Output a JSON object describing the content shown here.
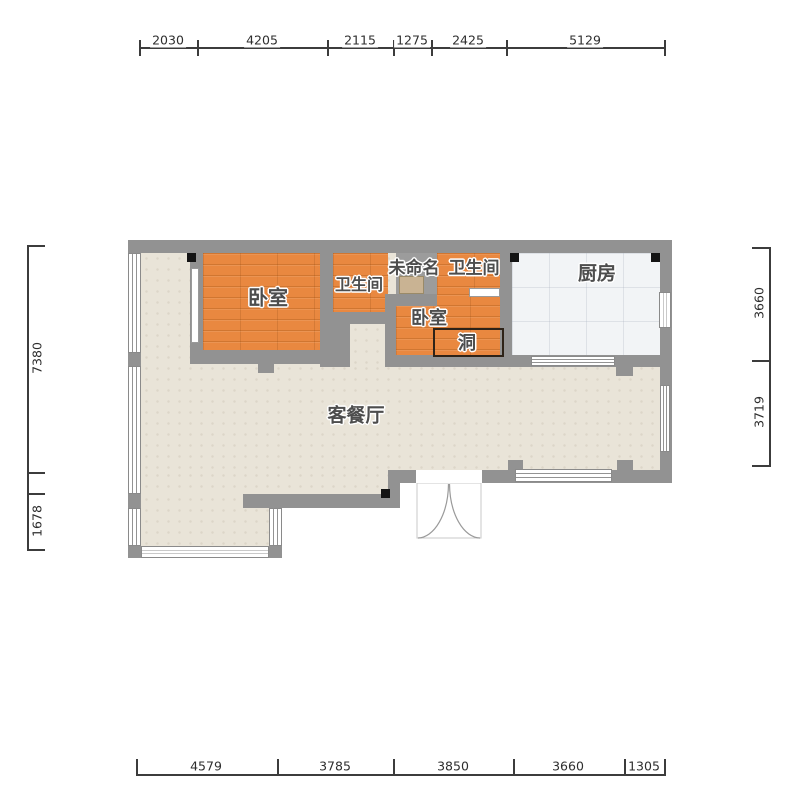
{
  "floorplan": {
    "rooms": {
      "bedroom1": {
        "label": "卧室"
      },
      "bathroom1": {
        "label": "卫生间"
      },
      "unnamed": {
        "label": "未命名"
      },
      "bathroom2": {
        "label": "卫生间"
      },
      "kitchen": {
        "label": "厨房"
      },
      "bedroom2": {
        "label": "卧室"
      },
      "hole": {
        "label": "洞"
      },
      "living": {
        "label": "客餐厅"
      }
    },
    "dims": {
      "top": [
        "2030",
        "4205",
        "2115",
        "1275",
        "2425",
        "5129"
      ],
      "bottom": [
        "4579",
        "3785",
        "3850",
        "3660",
        "1305"
      ],
      "left": [
        "7380",
        "1678"
      ],
      "right": [
        "3660",
        "3719"
      ]
    },
    "colors": {
      "wall": "#929292",
      "wood_floor": "#E98840",
      "living_floor": "#E9E4D8",
      "kitchen_floor": "#F2F4F6",
      "dimension_text": "#2E2E2E"
    }
  }
}
